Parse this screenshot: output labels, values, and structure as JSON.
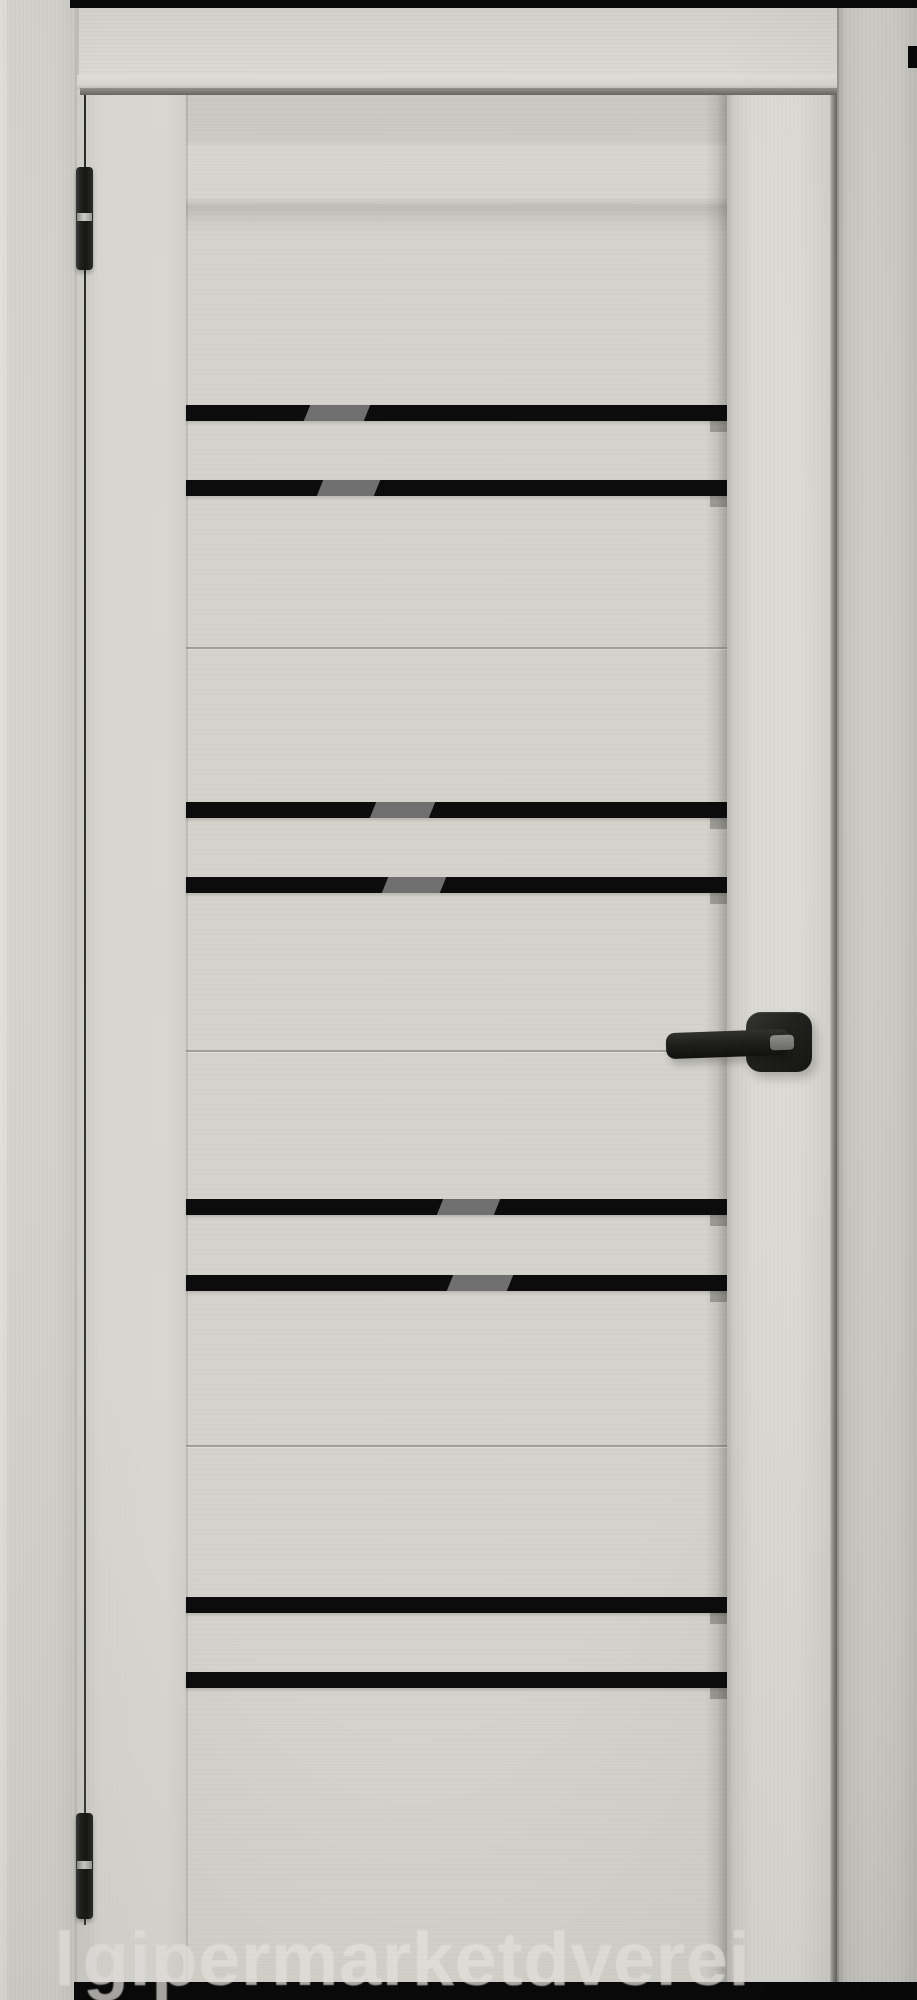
{
  "meta": {
    "subject": "interior-door-product-photo",
    "finish": "light-gray-textured",
    "glass": "black-stripe-inserts"
  },
  "watermark": {
    "leading_glyph": "l",
    "text": "gipermarketdverei"
  },
  "colors": {
    "background": "#cfcdc7",
    "panel": "#d5d3cc",
    "glass_stripe": "#0a0a0a",
    "stripe_reflection": "#6f6f6f",
    "hardware_black": "#1d1d1b",
    "strip_black": "#070707",
    "watermark": "#e8e6e1"
  },
  "door": {
    "panel_top": 95,
    "panel_left": 186,
    "stripe_height": 16,
    "stripes": [
      {
        "top": 405,
        "reflection": {
          "left": 307,
          "width": 60
        }
      },
      {
        "top": 480,
        "reflection": {
          "left": 320,
          "width": 57
        }
      },
      {
        "top": 802,
        "reflection": {
          "left": 373,
          "width": 59
        }
      },
      {
        "top": 877,
        "reflection": {
          "left": 385,
          "width": 58
        }
      },
      {
        "top": 1199,
        "reflection": {
          "left": 440,
          "width": 57
        }
      },
      {
        "top": 1275,
        "reflection": {
          "left": 450,
          "width": 60
        }
      },
      {
        "top": 1597,
        "reflection": null
      },
      {
        "top": 1672,
        "reflection": null
      }
    ],
    "seams": [
      647,
      1050,
      1445
    ],
    "hinges": [
      {
        "top": 167,
        "height": 103
      },
      {
        "top": 1813,
        "height": 106
      }
    ],
    "handle": {
      "rosette": {
        "left": 746,
        "top": 1012,
        "width": 66,
        "height": 60
      },
      "lever": {
        "left": 666,
        "top": 1031,
        "width": 124,
        "height": 26
      },
      "neck_highlight": {
        "left": 770,
        "top": 1035,
        "width": 24,
        "height": 15
      }
    }
  }
}
